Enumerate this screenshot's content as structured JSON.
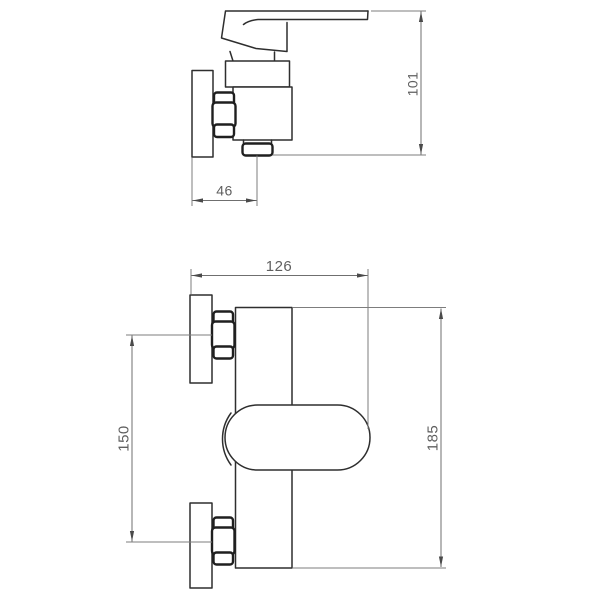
{
  "drawing_title": "shower-mixer-faucet-dimension-drawing",
  "dimensions": {
    "side_height": "101",
    "side_wall_to_outlet": "46",
    "front_width": "126",
    "front_total_height": "185",
    "front_connection_centers": "150"
  },
  "colors": {
    "background": "#ffffff",
    "part_outline": "#2e2e2e",
    "part_outline_thick": "#1f1f1f",
    "dimension_line": "#7d7d7d",
    "dimension_text": "#5f5f5f"
  }
}
